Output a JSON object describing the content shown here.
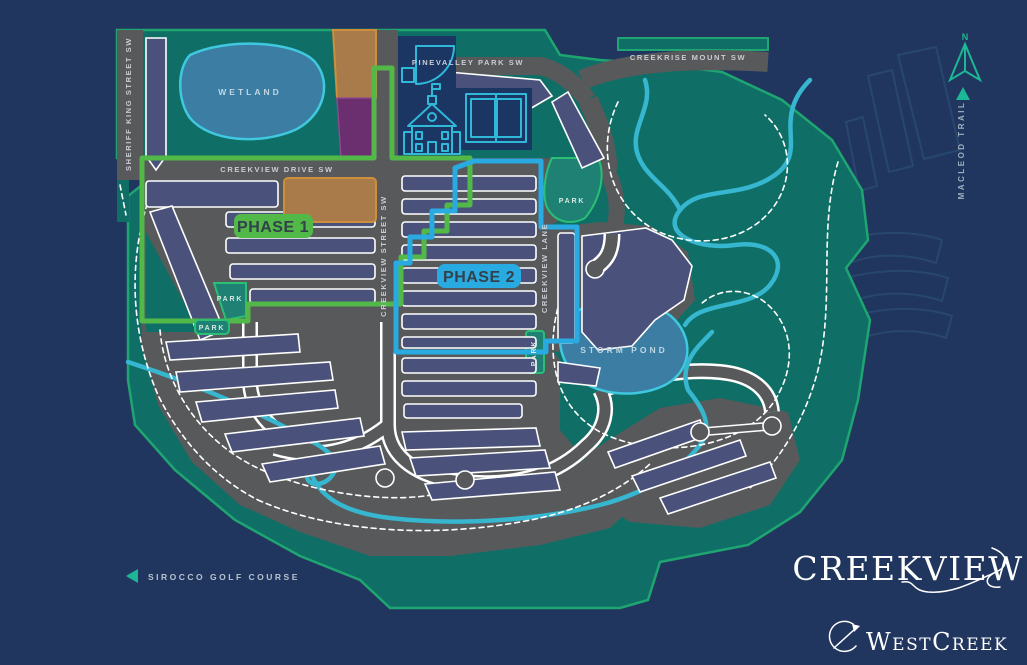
{
  "colors": {
    "navy": "#20365F",
    "navy2": "#1C3663",
    "land": "#0F6F66",
    "landEdge": "#1FA571",
    "park": "#1E8174",
    "parkEdge": "#2ABF74",
    "block": "#4A527B",
    "road": "#58595B",
    "roadLabel": "#C9CDD3",
    "water": "#3B7DA3",
    "waterEdge": "#3FC8E0",
    "creek": "#36B6CF",
    "phase1": "#52B848",
    "phase2": "#29ABE2",
    "badgeText": "#33414C",
    "tan": "#A97B4A",
    "tanEdge": "#CE8F3C",
    "purple": "#6B2F6F",
    "purpleEdge": "#8A4A8C",
    "icon": "#2FB8D8",
    "ghost": "#28476F",
    "teal": "#1CB795",
    "textLight": "#B9C3CE"
  },
  "map": {
    "streets": {
      "sheriff_king": "SHERIFF KING STREET SW",
      "creekview_drive": "CREEKVIEW DRIVE SW",
      "pinevalley_park": "PINEVALLEY PARK SW",
      "creekrise_mount": "CREEKRISE MOUNT SW",
      "creekview_street": "CREEKVIEW STREET SW",
      "creekview_lane": "CREEKVIEW LANE",
      "macleod_trail": "MACLEOD TRAIL"
    },
    "areas": {
      "wetland": "WETLAND",
      "storm_pond": "STORM POND",
      "park": "PARK"
    },
    "phases": {
      "phase1": "PHASE 1",
      "phase2": "PHASE 2"
    },
    "compass": {
      "north": "N"
    },
    "golf_course": "SIROCCO GOLF COURSE",
    "brand": {
      "community": "CREEKVIEW",
      "developer": "WestCreek"
    }
  }
}
